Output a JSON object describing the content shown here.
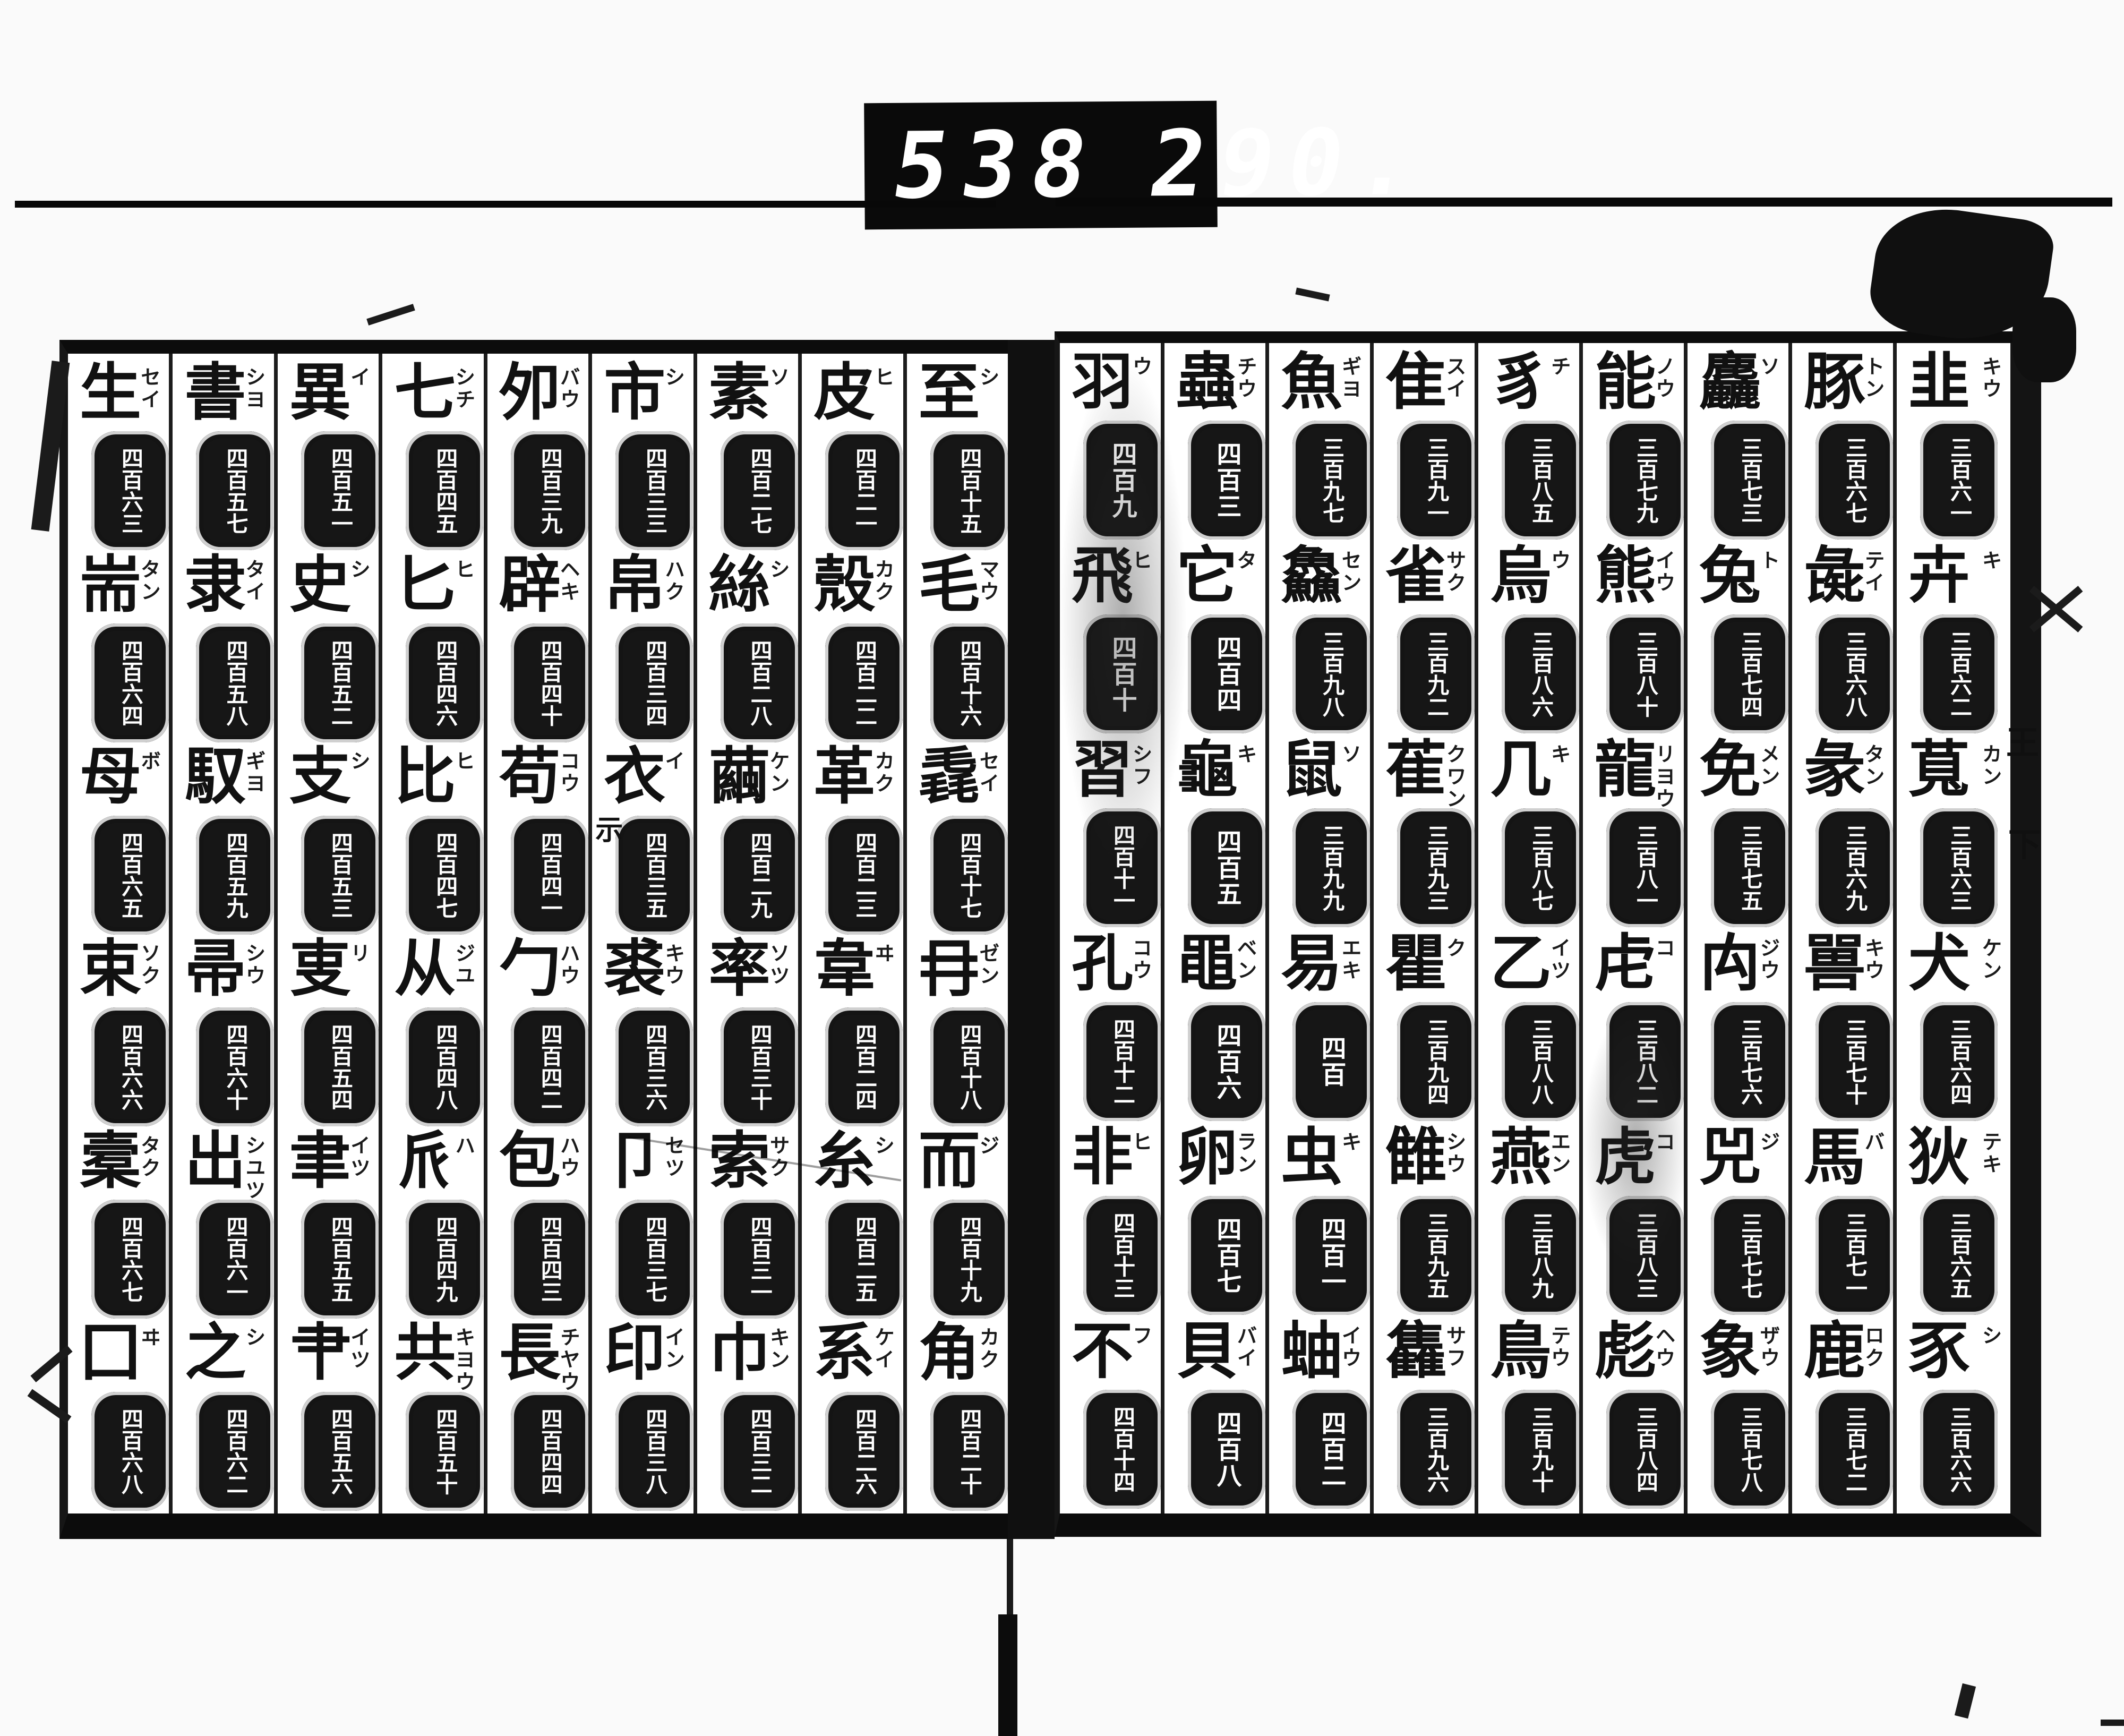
{
  "counter": {
    "left": "538",
    "right": "290."
  },
  "margin": {
    "right_marks": [
      "王",
      "下"
    ]
  },
  "colors": {
    "ink": "#111111",
    "paper": "#ffffff",
    "counter_bg": "#0a0a0a"
  },
  "pages": {
    "right": {
      "reading_order": "right-to-left",
      "columns": [
        {
          "entries": [
            {
              "k": "羽",
              "r": "ウ",
              "n": "四百九"
            },
            {
              "k": "飛",
              "r": "ヒ",
              "n": "四百十"
            },
            {
              "k": "習",
              "r": "シフ",
              "n": "四百十一"
            },
            {
              "k": "孔",
              "r": "コウ",
              "n": "四百十二"
            },
            {
              "k": "非",
              "r": "ヒ",
              "n": "四百十三"
            },
            {
              "k": "不",
              "r": "フ",
              "n": "四百十四"
            }
          ]
        },
        {
          "entries": [
            {
              "k": "蟲",
              "r": "チウ",
              "n": "四百三"
            },
            {
              "k": "它",
              "r": "タ",
              "n": "四百四"
            },
            {
              "k": "龜",
              "r": "キ",
              "n": "四百五"
            },
            {
              "k": "黽",
              "r": "ベン",
              "n": "四百六"
            },
            {
              "k": "卵",
              "r": "ラン",
              "n": "四百七"
            },
            {
              "k": "貝",
              "r": "バイ",
              "n": "四百八"
            }
          ]
        },
        {
          "entries": [
            {
              "k": "魚",
              "r": "ギヨ",
              "n": "三百九七"
            },
            {
              "k": "鱻",
              "r": "セン",
              "n": "三百九八"
            },
            {
              "k": "鼠",
              "r": "ソ",
              "n": "三百九九"
            },
            {
              "k": "易",
              "r": "エキ",
              "n": "四百"
            },
            {
              "k": "虫",
              "r": "キ",
              "n": "四百一"
            },
            {
              "k": "蚰",
              "r": "イウ",
              "n": "四百二"
            }
          ]
        },
        {
          "entries": [
            {
              "k": "隹",
              "r": "スイ",
              "n": "三百九一"
            },
            {
              "k": "雀",
              "r": "サク",
              "n": "三百九二"
            },
            {
              "k": "萑",
              "r": "クワン",
              "n": "三百九三"
            },
            {
              "k": "瞿",
              "r": "ク",
              "n": "三百九四"
            },
            {
              "k": "雔",
              "r": "シウ",
              "n": "三百九五"
            },
            {
              "k": "雥",
              "r": "サフ",
              "n": "三百九六"
            }
          ]
        },
        {
          "entries": [
            {
              "k": "豸",
              "r": "チ",
              "n": "三百八五"
            },
            {
              "k": "烏",
              "r": "ウ",
              "n": "三百八六"
            },
            {
              "k": "几",
              "r": "キ",
              "n": "三百八七"
            },
            {
              "k": "乙",
              "r": "イツ",
              "n": "三百八八"
            },
            {
              "k": "燕",
              "r": "エン",
              "n": "三百八九"
            },
            {
              "k": "鳥",
              "r": "テウ",
              "n": "三百九十"
            }
          ]
        },
        {
          "entries": [
            {
              "k": "能",
              "r": "ノウ",
              "n": "三百七九"
            },
            {
              "k": "熊",
              "r": "イウ",
              "n": "三百八十"
            },
            {
              "k": "龍",
              "r": "リヨウ",
              "n": "三百八一"
            },
            {
              "k": "虍",
              "r": "コ",
              "n": "三百八二"
            },
            {
              "k": "虎",
              "r": "コ",
              "n": "三百八三"
            },
            {
              "k": "彪",
              "r": "ヘウ",
              "n": "三百八四"
            }
          ]
        },
        {
          "entries": [
            {
              "k": "麤",
              "r": "ソ",
              "n": "三百七三"
            },
            {
              "k": "兔",
              "r": "ト",
              "n": "三百七四"
            },
            {
              "k": "免",
              "r": "メン",
              "n": "三百七五"
            },
            {
              "k": "禸",
              "r": "ジウ",
              "n": "三百七六"
            },
            {
              "k": "兕",
              "r": "ジ",
              "n": "三百七七"
            },
            {
              "k": "象",
              "r": "ザウ",
              "n": "三百七八"
            }
          ]
        },
        {
          "entries": [
            {
              "k": "豚",
              "r": "トン",
              "n": "三百六七"
            },
            {
              "k": "彘",
              "r": "テイ",
              "n": "三百六八"
            },
            {
              "k": "彖",
              "r": "タン",
              "n": "三百六九"
            },
            {
              "k": "嘼",
              "r": "キウ",
              "n": "三百七十"
            },
            {
              "k": "馬",
              "r": "バ",
              "n": "三百七一"
            },
            {
              "k": "鹿",
              "r": "ロク",
              "n": "三百七二"
            }
          ]
        },
        {
          "entries": [
            {
              "k": "韭",
              "r": "キウ",
              "n": "三百六一"
            },
            {
              "k": "卉",
              "r": "キ",
              "n": "三百六二"
            },
            {
              "k": "萈",
              "r": "カン",
              "n": "三百六三"
            },
            {
              "k": "犬",
              "r": "ケン",
              "n": "三百六四"
            },
            {
              "k": "狄",
              "r": "テキ",
              "n": "三百六五"
            },
            {
              "k": "豕",
              "r": "シ",
              "n": "三百六六"
            }
          ]
        }
      ]
    },
    "left": {
      "reading_order": "right-to-left",
      "columns": [
        {
          "entries": [
            {
              "k": "生",
              "r": "セイ",
              "n": "四百六三"
            },
            {
              "k": "耑",
              "r": "タン",
              "n": "四百六四"
            },
            {
              "k": "母",
              "r": "ボ",
              "n": "四百六五"
            },
            {
              "k": "束",
              "r": "ソク",
              "n": "四百六六"
            },
            {
              "k": "槖",
              "r": "タク",
              "n": "四百六七"
            },
            {
              "k": "囗",
              "r": "ヰ",
              "n": "四百六八"
            }
          ]
        },
        {
          "entries": [
            {
              "k": "書",
              "r": "シヨ",
              "n": "四百五七"
            },
            {
              "k": "隶",
              "r": "タイ",
              "n": "四百五八"
            },
            {
              "k": "馭",
              "r": "ギヨ",
              "n": "四百五九"
            },
            {
              "k": "帚",
              "r": "シウ",
              "n": "四百六十"
            },
            {
              "k": "出",
              "r": "シユツ",
              "n": "四百六一"
            },
            {
              "k": "之",
              "r": "シ",
              "n": "四百六二"
            }
          ]
        },
        {
          "entries": [
            {
              "k": "異",
              "r": "イ",
              "n": "四百五一"
            },
            {
              "k": "史",
              "r": "シ",
              "n": "四百五二"
            },
            {
              "k": "支",
              "r": "シ",
              "n": "四百五三"
            },
            {
              "k": "叓",
              "r": "リ",
              "n": "四百五四"
            },
            {
              "k": "聿",
              "r": "イツ",
              "n": "四百五五"
            },
            {
              "k": "肀",
              "r": "イツ",
              "n": "四百五六"
            }
          ]
        },
        {
          "entries": [
            {
              "k": "七",
              "r": "シチ",
              "n": "四百四五"
            },
            {
              "k": "匕",
              "r": "ヒ",
              "n": "四百四六"
            },
            {
              "k": "比",
              "r": "ヒ",
              "n": "四百四七"
            },
            {
              "k": "从",
              "r": "ジユ",
              "n": "四百四八"
            },
            {
              "k": "𠂢",
              "r": "ハ",
              "n": "四百四九"
            },
            {
              "k": "共",
              "r": "キヨウ",
              "n": "四百五十"
            }
          ]
        },
        {
          "entries": [
            {
              "k": "夘",
              "r": "バウ",
              "n": "四百三九"
            },
            {
              "k": "辟",
              "r": "ヘキ",
              "n": "四百四十"
            },
            {
              "k": "苟",
              "r": "コウ",
              "n": "四百四一"
            },
            {
              "k": "勹",
              "r": "ハウ",
              "n": "四百四二"
            },
            {
              "k": "包",
              "r": "ハウ",
              "n": "四百四三"
            },
            {
              "k": "長",
              "r": "チヤウ",
              "n": "四百四四"
            }
          ]
        },
        {
          "entries": [
            {
              "k": "市",
              "r": "シ",
              "n": "四百三三"
            },
            {
              "k": "帛",
              "r": "ハク",
              "n": "四百三四"
            },
            {
              "k": "衣",
              "r": "イ",
              "n": "四百三五",
              "s": "示"
            },
            {
              "k": "裘",
              "r": "キウ",
              "n": "四百三六"
            },
            {
              "k": "卩",
              "r": "セツ",
              "n": "四百三七"
            },
            {
              "k": "印",
              "r": "イン",
              "n": "四百三八"
            }
          ]
        },
        {
          "entries": [
            {
              "k": "素",
              "r": "ソ",
              "n": "四百二七"
            },
            {
              "k": "絲",
              "r": "シ",
              "n": "四百二八"
            },
            {
              "k": "繭",
              "r": "ケン",
              "n": "四百二九"
            },
            {
              "k": "率",
              "r": "ソツ",
              "n": "四百三十"
            },
            {
              "k": "索",
              "r": "サク",
              "n": "四百三一"
            },
            {
              "k": "巾",
              "r": "キン",
              "n": "四百三二"
            }
          ]
        },
        {
          "entries": [
            {
              "k": "皮",
              "r": "ヒ",
              "n": "四百二一"
            },
            {
              "k": "殼",
              "r": "カク",
              "n": "四百二二"
            },
            {
              "k": "革",
              "r": "カク",
              "n": "四百二三"
            },
            {
              "k": "韋",
              "r": "ヰ",
              "n": "四百二四"
            },
            {
              "k": "糸",
              "r": "シ",
              "n": "四百二五"
            },
            {
              "k": "系",
              "r": "ケイ",
              "n": "四百二六"
            }
          ]
        },
        {
          "entries": [
            {
              "k": "至",
              "r": "シ",
              "n": "四百十五"
            },
            {
              "k": "毛",
              "r": "マウ",
              "n": "四百十六"
            },
            {
              "k": "毳",
              "r": "セイ",
              "n": "四百十七"
            },
            {
              "k": "冄",
              "r": "ゼン",
              "n": "四百十八"
            },
            {
              "k": "而",
              "r": "ジ",
              "n": "四百十九"
            },
            {
              "k": "角",
              "r": "カク",
              "n": "四百二十"
            }
          ]
        }
      ]
    }
  }
}
